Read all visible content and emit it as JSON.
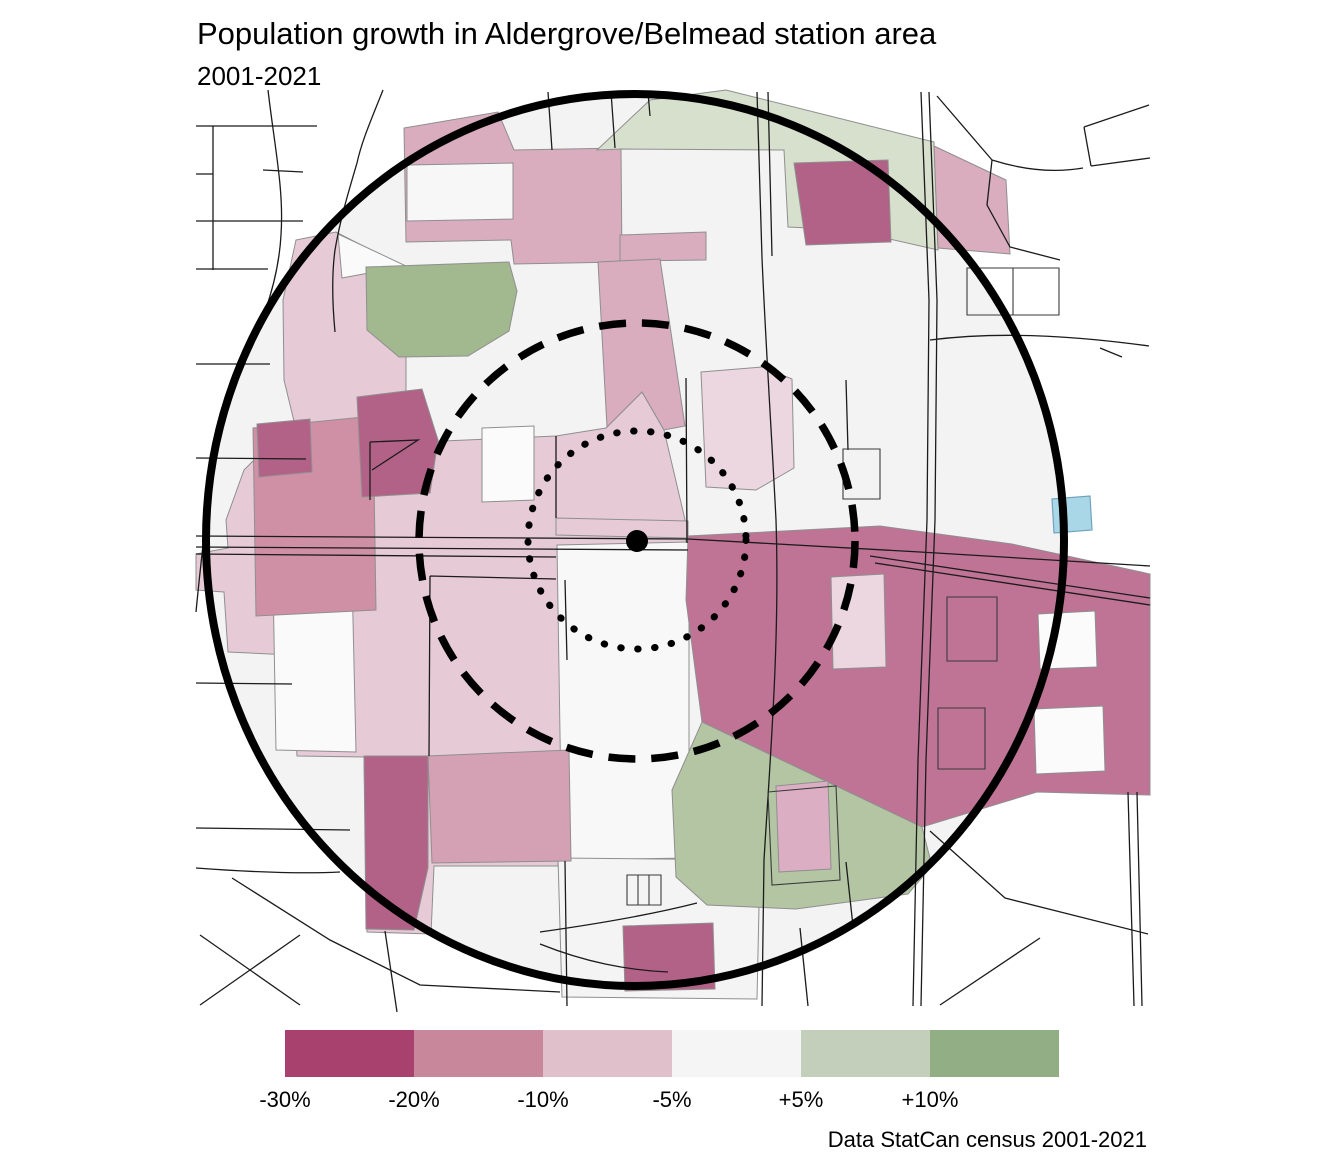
{
  "title": "Population growth in Aldergrove/Belmead station area",
  "subtitle": "2001-2021",
  "caption": "Data StatCan census 2001-2021",
  "legend": {
    "labels": [
      "-30%",
      "-20%",
      "-10%",
      "-5%",
      "+5%",
      "+10%"
    ],
    "colors": [
      "#a8416d",
      "#c9879b",
      "#dfc0cb",
      "#f6f5f5",
      "#c3cfba",
      "#92ae85"
    ]
  },
  "map": {
    "water_color": "#a9d7e8",
    "ring_color": "#000000"
  }
}
